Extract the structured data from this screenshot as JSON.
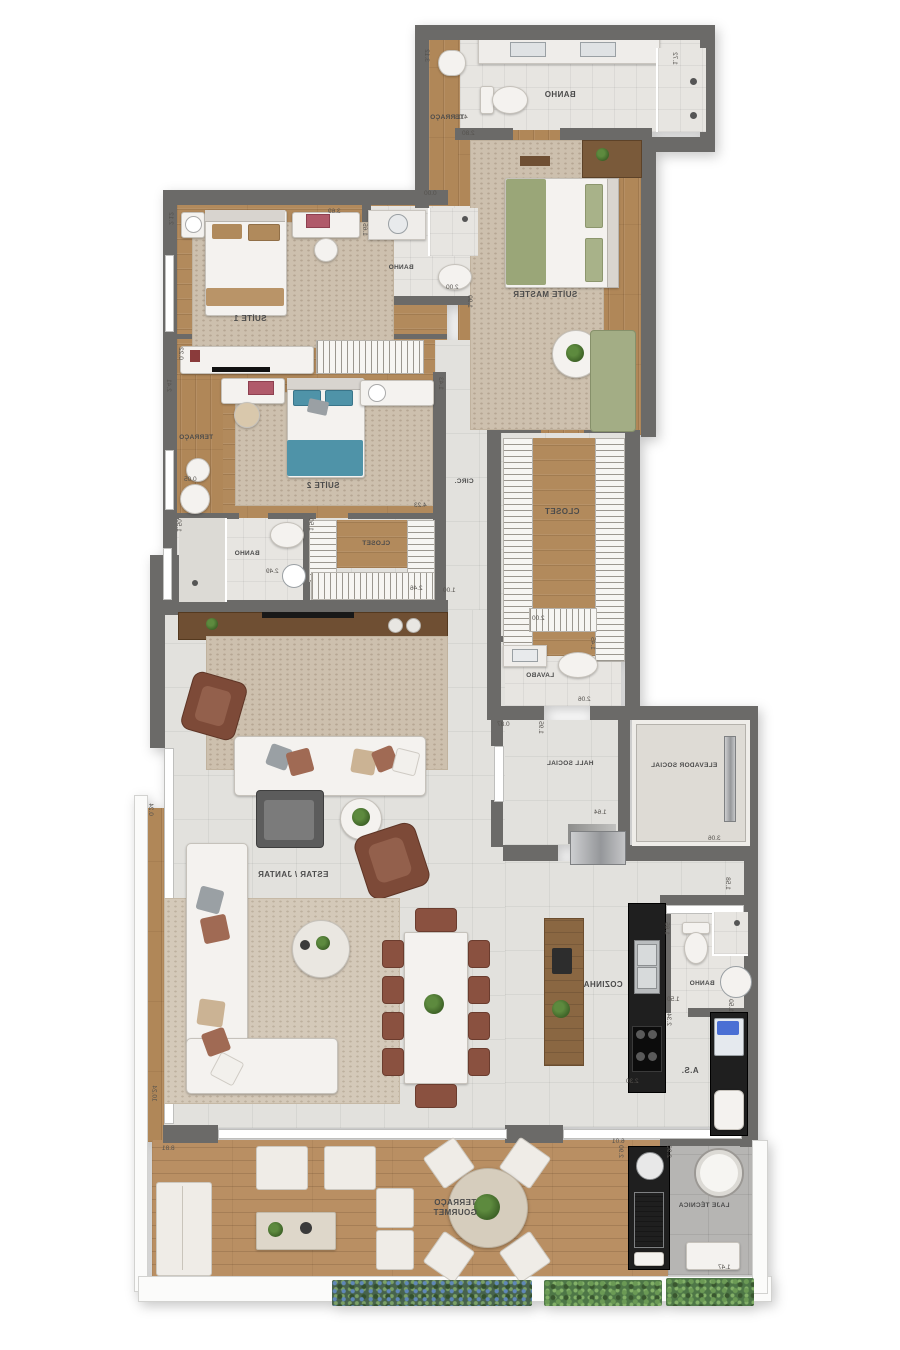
{
  "plan": {
    "type": "residential-apartment-floor-plan",
    "orientation": "mirrored-text",
    "colors": {
      "wall": "#6b6a68",
      "wood": "#b08758",
      "tile": "#e2e1dd",
      "rug": "#cdc0ae",
      "master_bed_green": "#9aa678",
      "suite2_bed_teal": "#4f93a8",
      "counter_black": "#1f1f1f",
      "hedge_green": "#4e7747",
      "concrete": "#b6b5b3"
    }
  },
  "rooms": {
    "banho_master": {
      "label": "BANHO"
    },
    "terraco_top": {
      "label": "TERRAÇO"
    },
    "suite_master": {
      "label": "SUÍTE MASTER"
    },
    "suite1": {
      "label": "SUÍTE 1"
    },
    "banho_suite1": {
      "label": "BANHO"
    },
    "terraco_suite2": {
      "label": "TERRAÇO"
    },
    "suite2": {
      "label": "SUÍTE 2"
    },
    "banho_suite2": {
      "label": "BANHO"
    },
    "closet_suite2": {
      "label": "CLOSET"
    },
    "circ": {
      "label": "CIRC."
    },
    "closet_master": {
      "label": "CLOSET"
    },
    "lavabo": {
      "label": "LAVABO"
    },
    "hall_social": {
      "label": "HALL SOCIAL"
    },
    "elevador_social": {
      "label": "ELEVADOR SOCIAL"
    },
    "estar_jantar": {
      "label": "ESTAR / JANTAR"
    },
    "cozinha": {
      "label": "COZINHA"
    },
    "banho_servico": {
      "label": "BANHO"
    },
    "area_servico": {
      "label": "A.S."
    },
    "terraco_gourmet": {
      "label": "TERRAÇO GOURMET"
    },
    "laje_tecnica": {
      "label": "LAJE TÉCNICA"
    }
  },
  "dims": [
    "3.12",
    "1.72",
    "4.03",
    "2.80",
    "0.00",
    "3.69",
    "2.12",
    "1.65",
    "2.00",
    "1.90",
    "0.22",
    "1.43",
    "2.41",
    "0.05",
    "4.23",
    "1.50",
    "2.49",
    "1.50",
    "2.46",
    "1.00",
    "2.00",
    "1.45",
    "2.06",
    "0.87",
    "1.95",
    "1.64",
    "3.06",
    "1.58",
    "1.65",
    "1.50",
    "1.50",
    "2.34",
    "2.30",
    "6.01",
    "0.24",
    "10.24",
    "8.81",
    "2.90",
    "2.90",
    "1.47"
  ]
}
